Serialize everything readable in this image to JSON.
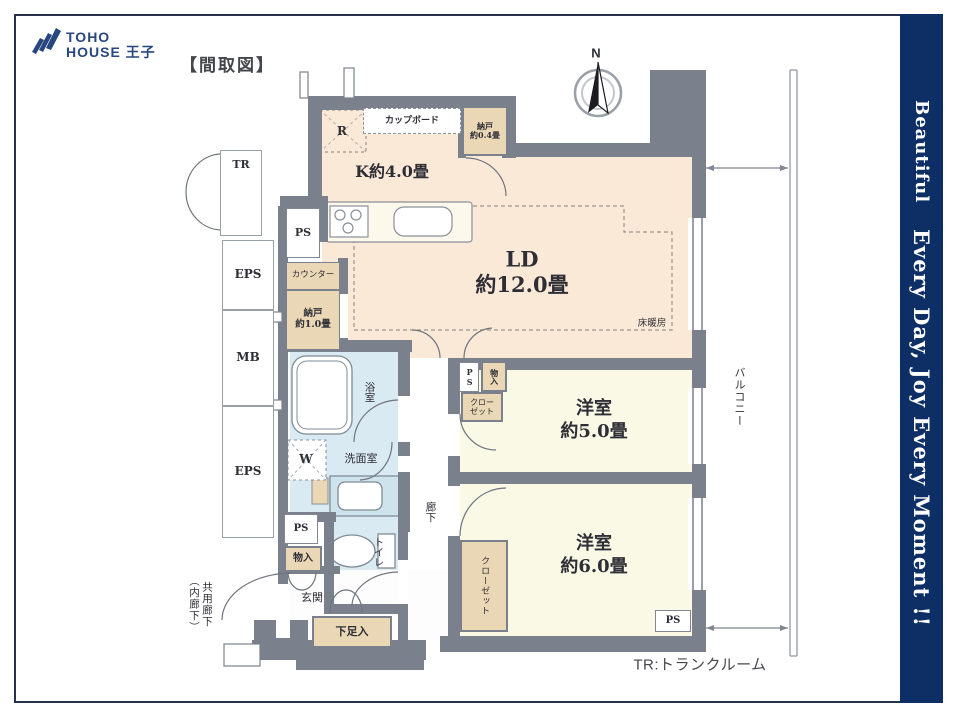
{
  "header": {
    "logo_top": "TOHO",
    "logo_bottom": "HOUSE 王子",
    "plan_label": "【間取図】"
  },
  "compass": {
    "north": "N"
  },
  "side_band": {
    "line1": "Beautiful",
    "line2": "Every Day, Joy Every Moment !!"
  },
  "notes": {
    "tr_legend": "TR:トランクルーム"
  },
  "rooms": {
    "kitchen": "K約4.0畳",
    "living_line1": "LD",
    "living_line2": "約12.0畳",
    "floor_heating": "床暖房",
    "bedroom5_line1": "洋室",
    "bedroom5_line2": "約5.0畳",
    "bedroom6_line1": "洋室",
    "bedroom6_line2": "約6.0畳",
    "bath": "浴室",
    "washroom": "洗面室",
    "toilet": "トイレ",
    "hallway": "廊下",
    "entrance": "玄関",
    "balcony": "バルコニー",
    "shared_corridor_line1": "共用廊下",
    "shared_corridor_line2": "（内廊下）"
  },
  "labels": {
    "fridge": "R",
    "cupboard": "カップボード",
    "nando04_line1": "納戸",
    "nando04_line2": "約0.4畳",
    "counter": "カウンター",
    "nando10_line1": "納戸",
    "nando10_line2": "約1.0畳",
    "washer": "W",
    "ps": "PS",
    "eps": "EPS",
    "mb": "MB",
    "tr": "TR",
    "storage": "物入",
    "closet_line1": "クロー",
    "closet_line2": "ゼット",
    "closet": "クローゼット",
    "shoe_box": "下足入"
  },
  "colors": {
    "wall": "#7b818c",
    "floor_ld": "#fbe9d8",
    "floor_bedroom": "#f9f9e6",
    "floor_wet": "#daeaf2",
    "storage_tan": "#ead7b5",
    "brand_navy": "#0d2f66"
  }
}
